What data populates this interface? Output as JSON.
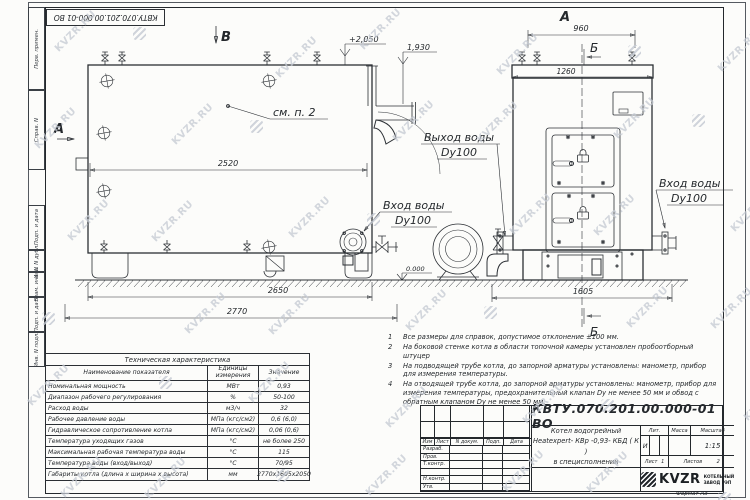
{
  "watermark": {
    "text": "KVZR.RU"
  },
  "sheet": {
    "doc_number_stamp": "КВТУ.070.201.00.000-01 ВО",
    "format_label": "Формат А3",
    "left_margin_labels": [
      "Перв. примен.",
      "Справ. N",
      "Подп. и дата",
      "Инв. N дубл.",
      "Взам. инв. N",
      "Подп. и дата",
      "Инв. N подл."
    ]
  },
  "views": {
    "letter_a_left": "А",
    "letter_a_top": "А",
    "letter_b_top": "Б",
    "letter_b_bottom": "Б",
    "letter_v": "В",
    "see_note": "см. п. 2",
    "outlet_label_1": "Выход воды",
    "outlet_label_2": "Dy100",
    "inlet_left_label_1": "Вход воды",
    "inlet_left_label_2": "Dy100",
    "inlet_right_label_1": "Вход воды",
    "inlet_right_label_2": "Dy100",
    "dim_2520": "2520",
    "dim_2650": "2650",
    "dim_2770": "2770",
    "dim_960": "960",
    "dim_1260": "1260",
    "dim_1605": "1605",
    "elev_top": "+2,050",
    "elev_flue": "1,930",
    "elev_zero": "0.000"
  },
  "tech_table": {
    "title": "Техническая характеристика",
    "col_headers": [
      "Наименование показателя",
      "Единицы измерения",
      "Значение"
    ],
    "rows": [
      [
        "Номинальная мощность",
        "МВт",
        "0,93"
      ],
      [
        "Диапазон рабочего регулирования",
        "%",
        "50-100"
      ],
      [
        "Расход воды",
        "м3/ч",
        "32"
      ],
      [
        "Рабочее давление воды",
        "МПа (кгс/см2)",
        "0,6 (6,0)"
      ],
      [
        "Гидравлическое сопротивление котла",
        "МПа (кгс/см2)",
        "0,06 (0,6)"
      ],
      [
        "Температура уходящих газов",
        "°С",
        "не более 250"
      ],
      [
        "Максимальная рабочая температура воды",
        "°С",
        "115"
      ],
      [
        "Температура воды (вход/выход)",
        "°С",
        "70/95"
      ],
      [
        "Габариты котла (длина х ширина х высота)",
        "мм",
        "2770х1605х2050"
      ]
    ]
  },
  "notes": {
    "items": [
      {
        "num": "1",
        "text": "Все размеры для справок, допустимое отклонение ±100 мм."
      },
      {
        "num": "2",
        "text": "На боковой стенке котла в области топочной камеры установлен пробоотборный штуцер"
      },
      {
        "num": "3",
        "text": "На подводящей трубе котла, до запорной арматуры установлены: манометр, прибор для измерения температуры."
      },
      {
        "num": "4",
        "text": "На отводящей трубе котла, до запорной арматуры установлены: манометр, прибор для измерения температуры, предохранительный клапан Dy не менее 50 мм и обвод с обратным клапаном Dy не менее 50 мм."
      }
    ]
  },
  "title_block": {
    "doc_number": "КВТУ.070.201.00.000-01 ВО",
    "change_cols": [
      "Изм",
      "Лист",
      "N докум.",
      "Подп.",
      "Дата"
    ],
    "roles": [
      "Разраб.",
      "Пров.",
      "Т.контр.",
      "",
      "Н.контр.",
      "Утв."
    ],
    "product_line1": "Котел водогрейный",
    "product_line2": "Heatexpert- КВр -0,93- КБД ( К )",
    "product_line3": "в специсполнении",
    "lit_header": "Лит.",
    "mass_header": "Масса",
    "scale_header": "Масштаб",
    "lit_value": "И",
    "scale_value": "1:15",
    "sheet_label": "Лист",
    "sheet_num": "1",
    "sheets_label": "Листов",
    "sheets_num": "2",
    "logo_text": "KVZR",
    "company_line1": "КОТЕЛЬНЫЙ",
    "company_line2": "ЗАВОД РЭП"
  }
}
